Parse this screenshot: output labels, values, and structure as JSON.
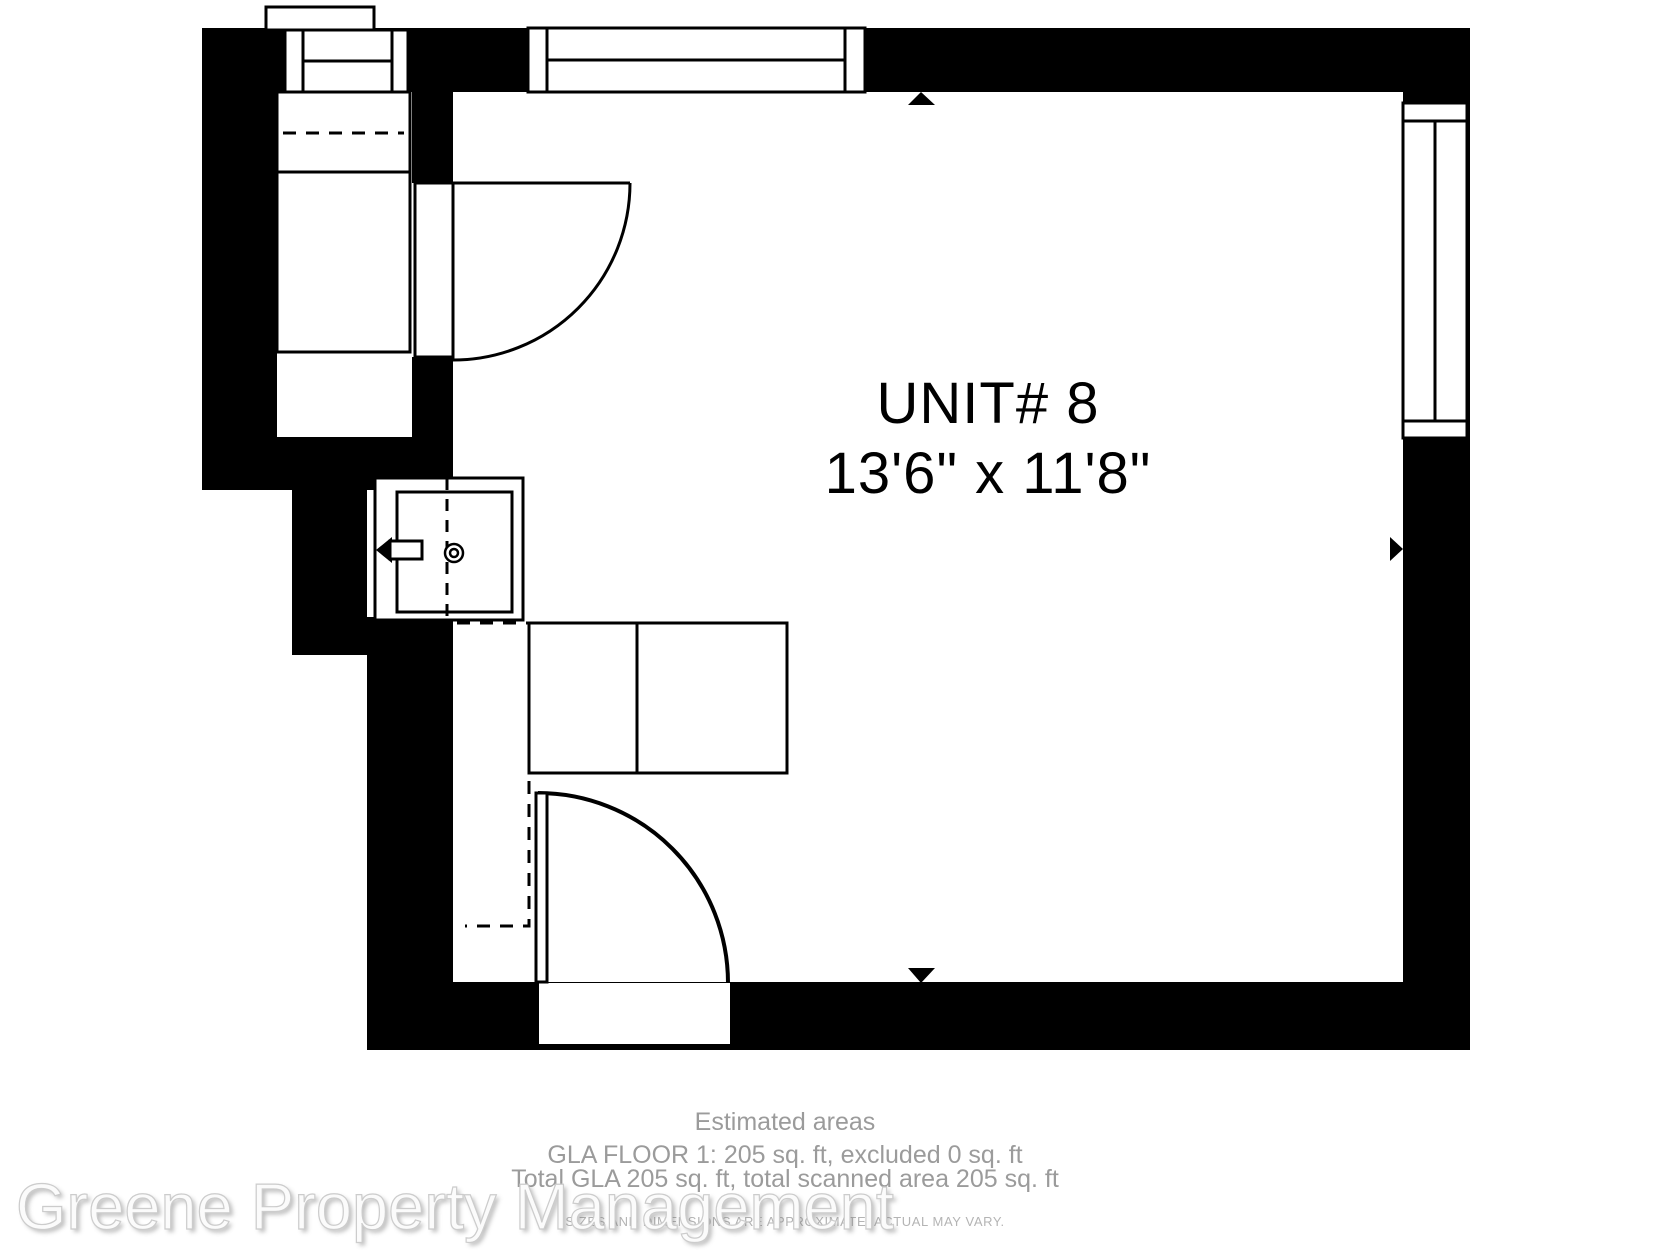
{
  "unit": {
    "label": "UNIT# 8",
    "dimensions": "13'6\" x 11'8\""
  },
  "footer": {
    "estimated_areas": "Estimated areas",
    "gla_floor": "GLA FLOOR 1: 205 sq. ft, excluded 0 sq. ft",
    "total_gla": "Total GLA 205 sq. ft, total scanned area 205 sq. ft",
    "disclaimer": "SIZES AND DIMENSIONS ARE APPROXIMATE, ACTUAL MAY VARY."
  },
  "watermark": {
    "text": "Greene Property Management"
  },
  "colors": {
    "wall": "#000000",
    "background": "#ffffff",
    "footer_text": "#9b9b9b",
    "disclaimer_text": "#b4b4b4",
    "watermark_text": "#fbfbfb"
  }
}
